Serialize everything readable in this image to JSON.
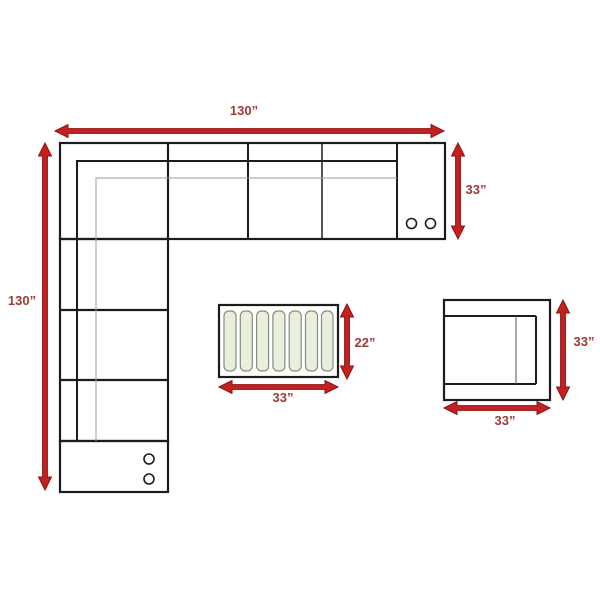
{
  "diagram": {
    "type": "furniture-dimension-diagram",
    "pieces": {
      "sectional_sofa": {
        "name": "L-shaped sectional sofa (top view)",
        "width_label": "130”",
        "length_label": "130”",
        "depth_label": "33”",
        "seat_dividers_top_row": 4,
        "cupholders_console": 2,
        "cupholders_end_piece": 2
      },
      "ottoman": {
        "name": "slatted storage ottoman (top view)",
        "slat_count": 7,
        "depth_label": "22”",
        "width_label": "33”"
      },
      "chair": {
        "name": "armchair (top view)",
        "depth_label": "33”",
        "width_label": "33”"
      }
    },
    "colors": {
      "arrow": "#c42020",
      "arrow_edge": "#8e1111",
      "label": "#a03a36",
      "line": "#1c1c1c",
      "soft_line": "#9d9d9d",
      "stripe_fill": "#e8f0dc",
      "stripe_border": "#878d80",
      "background": "#ffffff"
    }
  }
}
